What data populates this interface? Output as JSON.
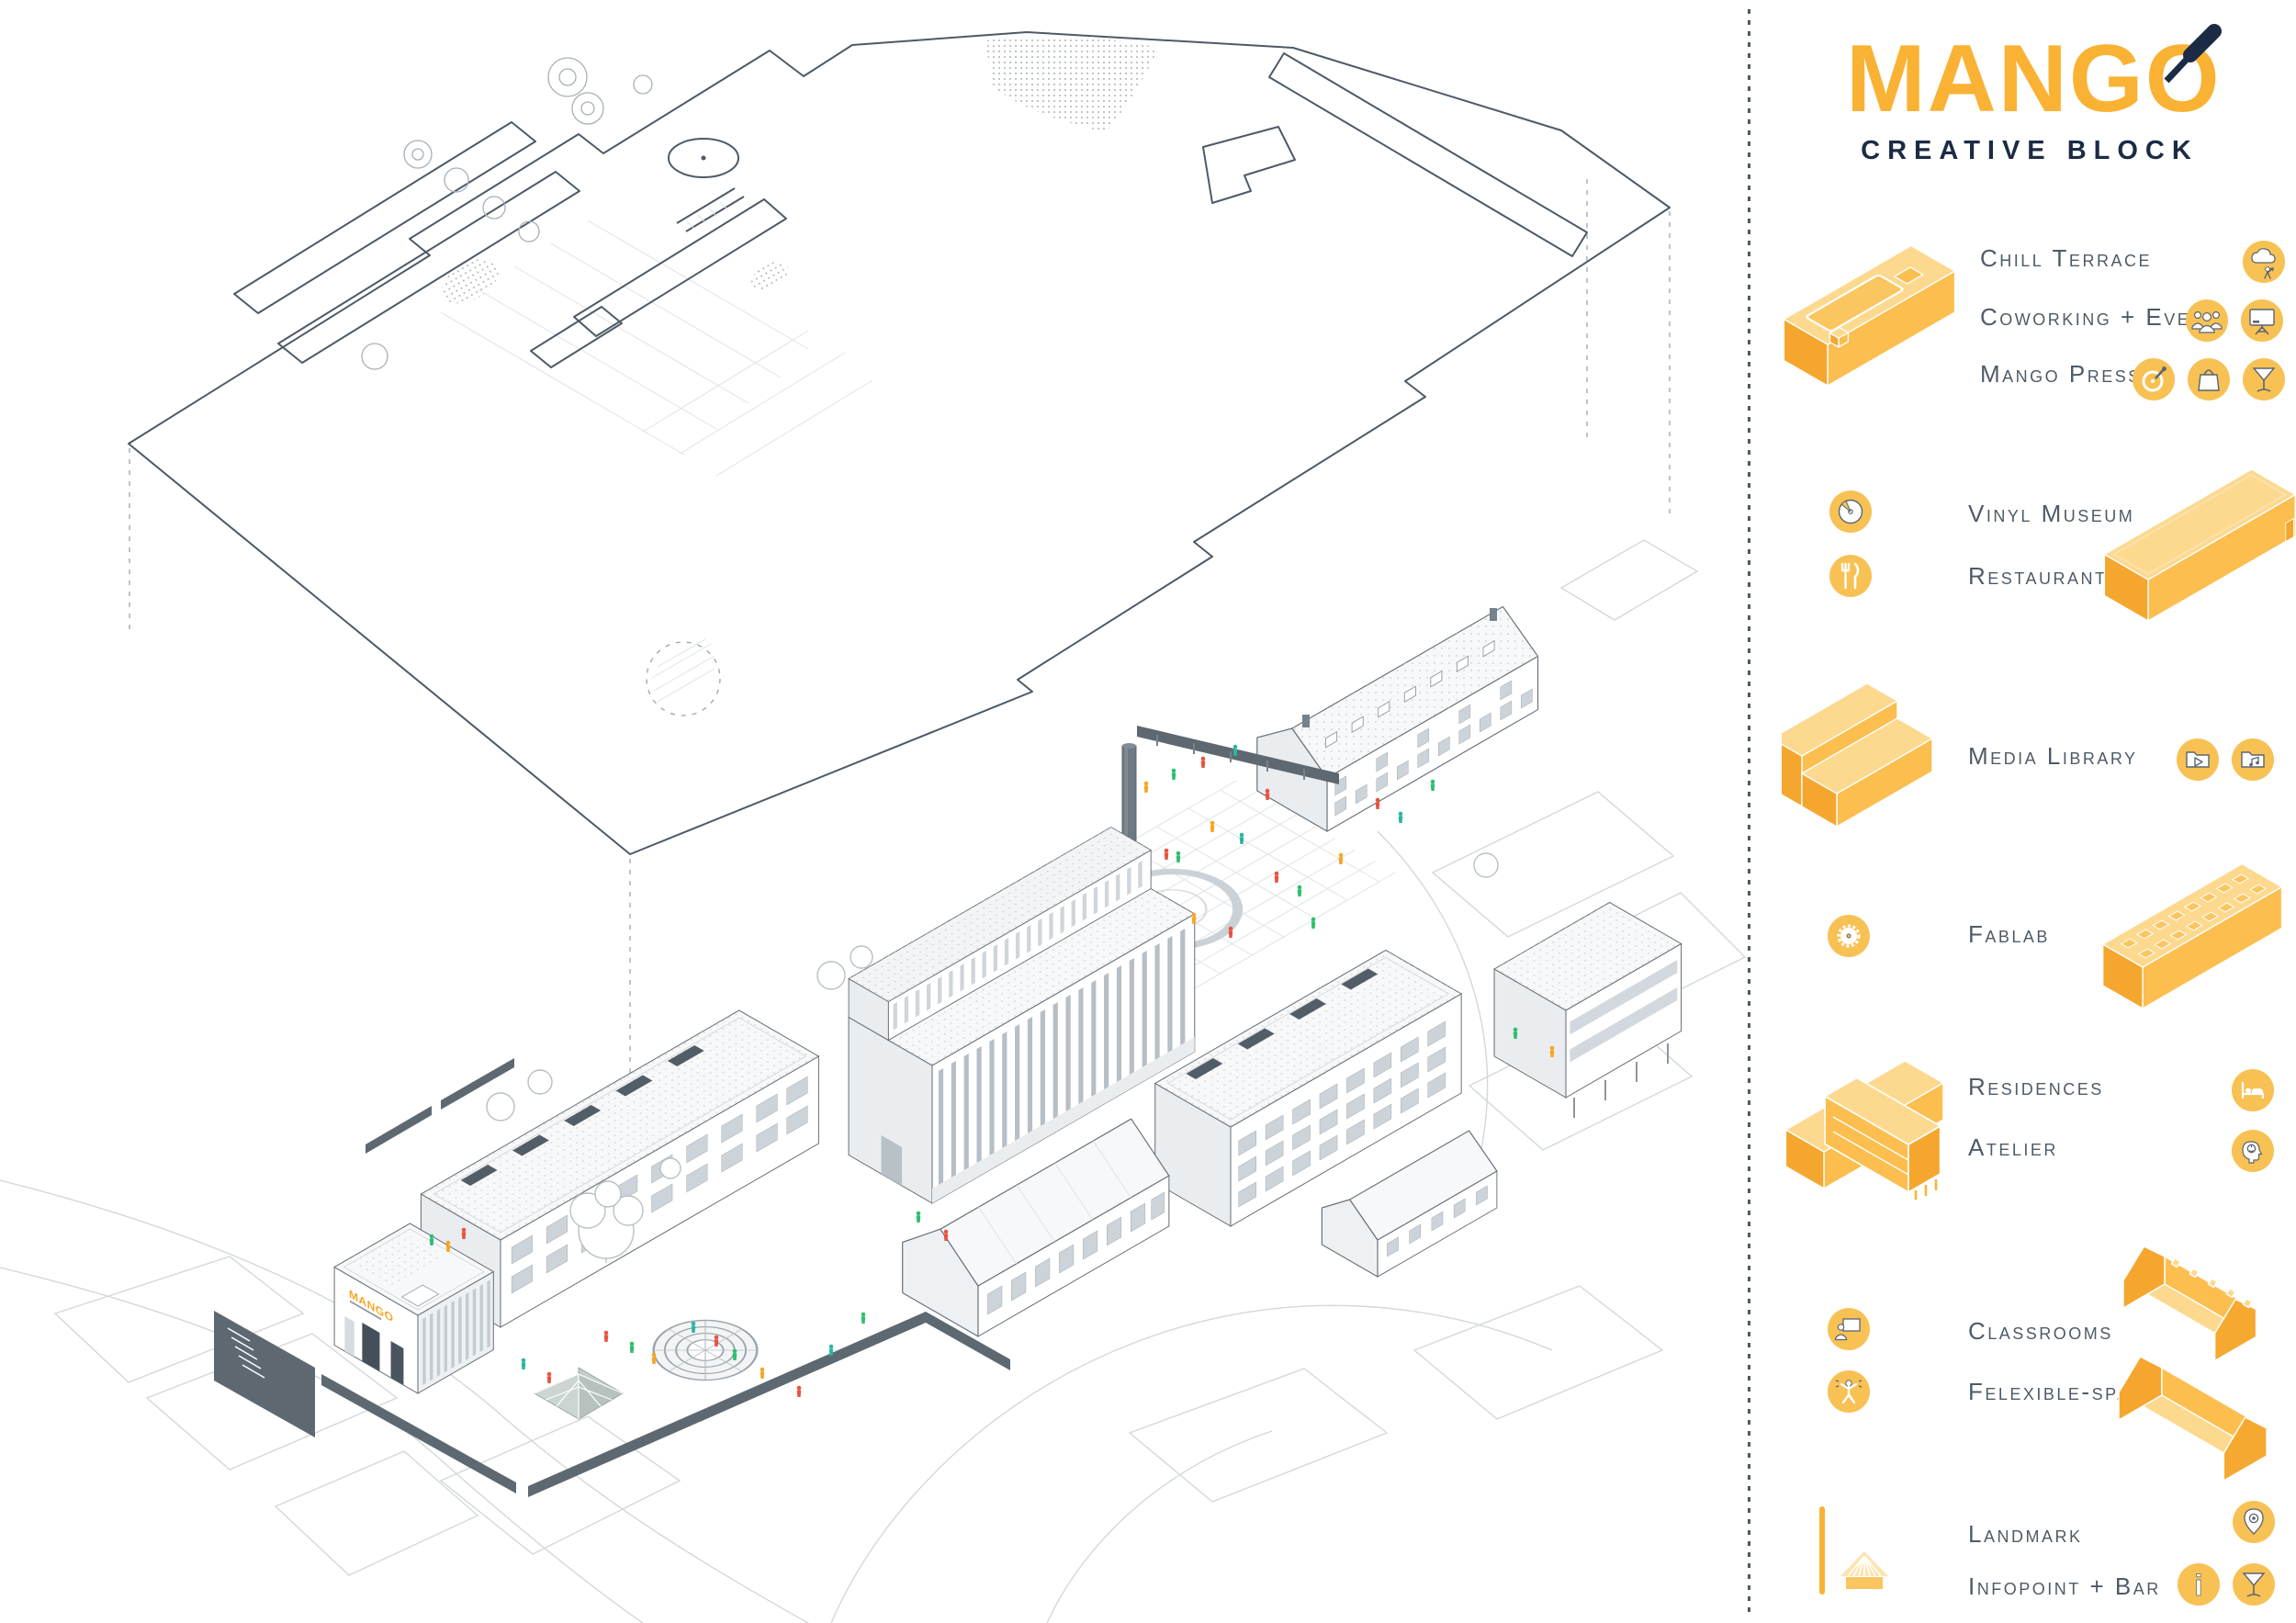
{
  "brand": {
    "name": "MANGO",
    "subtitle": "CREATIVE BLOCK"
  },
  "drawing": {
    "building_sign": "MANGO"
  },
  "legend": {
    "groups": [
      {
        "name": "terrace-block",
        "rows": [
          {
            "label": "Chill Terrace",
            "icons": [
              "weather-person-icon"
            ]
          },
          {
            "label": "Coworking + Events",
            "icons": [
              "people-group-icon",
              "presentation-screen-icon"
            ]
          },
          {
            "label": "Mango Press",
            "icons": [
              "vinyl-player-icon",
              "shopping-bag-icon",
              "martini-glass-icon"
            ]
          }
        ]
      },
      {
        "name": "museum-block",
        "rows": [
          {
            "label": "Vinyl Museum",
            "icons": [
              "vinyl-record-icon"
            ]
          },
          {
            "label": "Restaurant",
            "icons": [
              "fork-knife-icon"
            ]
          }
        ]
      },
      {
        "name": "media-block",
        "rows": [
          {
            "label": "Media Library",
            "icons": [
              "video-folder-icon",
              "music-folder-icon"
            ]
          }
        ]
      },
      {
        "name": "fablab-block",
        "rows": [
          {
            "label": "Fablab",
            "icons": [
              "saw-blade-icon"
            ]
          }
        ]
      },
      {
        "name": "residences-block",
        "rows": [
          {
            "label": "Residences",
            "icons": [
              "bed-icon"
            ]
          },
          {
            "label": "Atelier",
            "icons": [
              "creative-head-icon"
            ]
          }
        ]
      },
      {
        "name": "classrooms-block",
        "rows": [
          {
            "label": "Classrooms",
            "icons": [
              "teacher-board-icon"
            ]
          },
          {
            "label": "Felexible-spaces",
            "icons": [
              "active-person-icon"
            ]
          }
        ]
      },
      {
        "name": "landmark-block",
        "rows": [
          {
            "label": "Landmark",
            "icons": [
              "location-pin-icon"
            ]
          },
          {
            "label": "Infopoint + Bar",
            "icons": [
              "info-icon",
              "martini-glass-icon"
            ]
          }
        ]
      }
    ]
  },
  "colors": {
    "accent": "#F9B233",
    "accent_light": "#FCD98F",
    "accent_mid": "#FBBE4F",
    "accent_deep": "#F5A62E",
    "navy": "#1C2B45",
    "ink": "#4D5A66",
    "line": "#6A737C"
  }
}
